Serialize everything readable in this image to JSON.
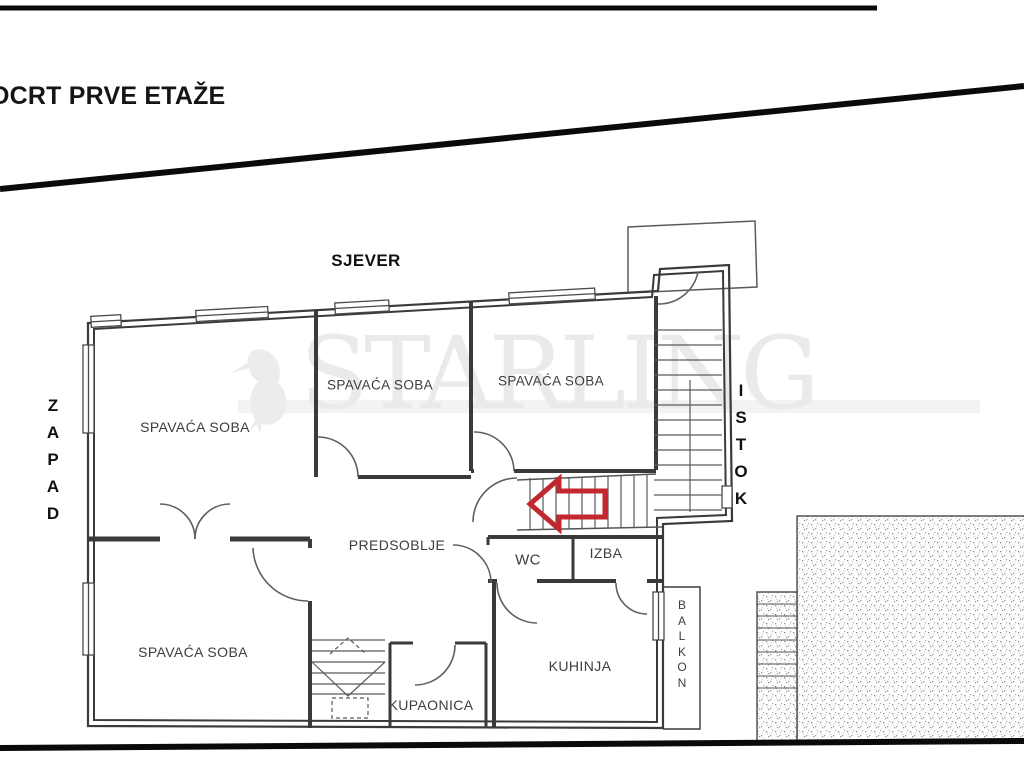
{
  "title": "OCRT PRVE ETAŽE",
  "compass": {
    "north": "SJEVER",
    "west": "ZAPAD",
    "east": "ISTOK"
  },
  "rooms": {
    "bedroom_nw": "SPAVAĆA SOBA",
    "bedroom_n": "SPAVAĆA SOBA",
    "bedroom_ne": "SPAVAĆA SOBA",
    "bedroom_sw": "SPAVAĆA SOBA",
    "hallway": "PREDSOBLJE",
    "wc": "WC",
    "pantry": "IZBA",
    "kitchen": "KUHINJA",
    "bathroom": "KUPAONICA",
    "balcony": "BALKON"
  },
  "watermark": {
    "brand": "STARLING"
  },
  "colors": {
    "arrow_red": "#c1272d",
    "line_black": "#111111",
    "wall_gray": "#3a3a3a"
  }
}
